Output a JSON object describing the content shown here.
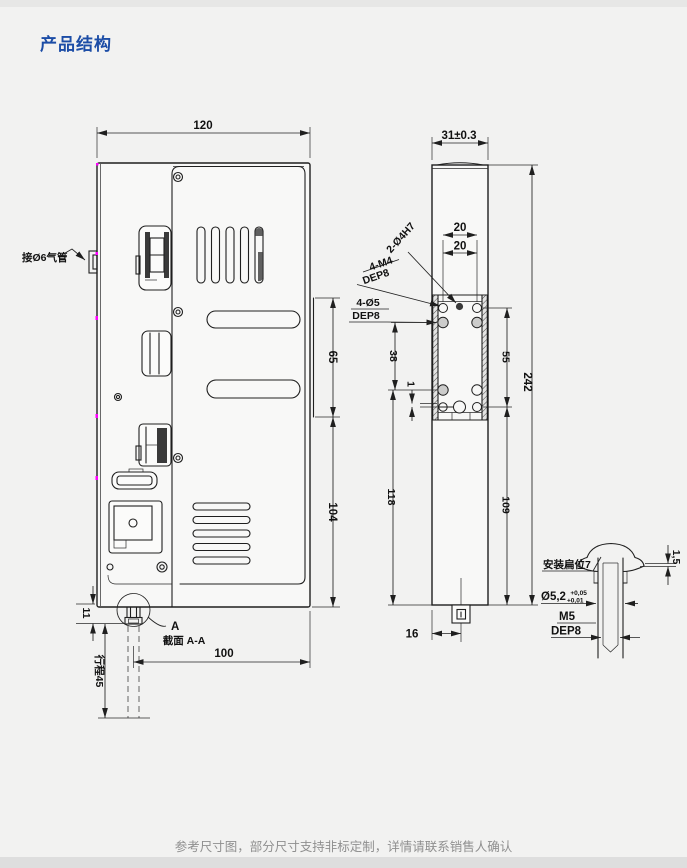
{
  "title": "产品结构",
  "footer": {
    "note": "参考尺寸图，部分尺寸支持非标定制，详情请联系销售人确认"
  },
  "colors": {
    "title_blue": "#1c4da6",
    "drawing_line": "#1f1f1f",
    "note_gray": "#8f8f8f",
    "vertex_magenta": "#ff00ff",
    "page_bg": "#f2f2f1"
  },
  "front_view": {
    "air_fitting_label": "接Ø6气管",
    "dim_width": "120",
    "dim_slot_span": "65",
    "dim_lower_span": "104",
    "dim_boss": "11",
    "dim_stroke": "行程45",
    "dim_rod_to_edge": "100",
    "section_marker": "A",
    "section_caption": "截面 A-A"
  },
  "side_view": {
    "dim_depth": "31±0.3",
    "dim_pitch_top": "20",
    "dim_pitch_bottom": "20",
    "callout_dowel": "2-Ø4H7",
    "callout_m4": "4-M4",
    "callout_m4_depth": "DEP8",
    "callout_d5": "4-Ø5",
    "callout_d5_depth": "DEP8",
    "dim_38": "38",
    "dim_1": "1",
    "dim_55": "55",
    "dim_118": "118",
    "dim_109": "109",
    "dim_242": "242",
    "dim_16": "16"
  },
  "detail_view": {
    "flat_label": "安装扁位7",
    "dim_cap": "1,5",
    "bore_dia": "Ø5,2",
    "bore_tol_up": "+0,05",
    "bore_tol_low": "+0,01",
    "thread": "M5",
    "thread_depth": "DEP8"
  }
}
